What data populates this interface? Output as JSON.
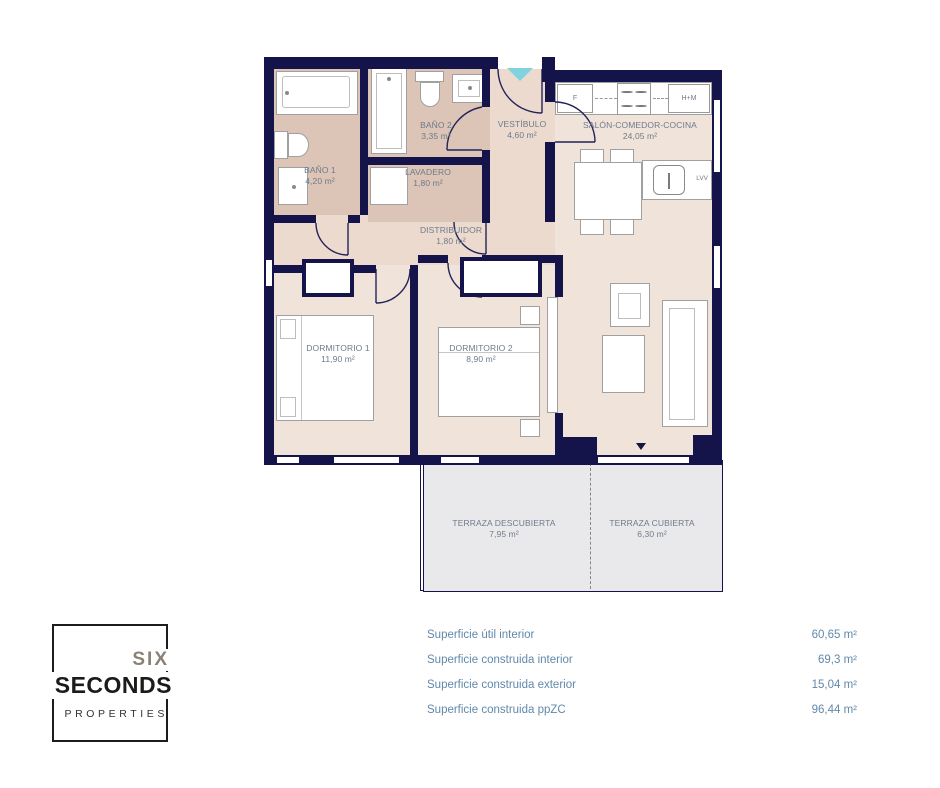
{
  "plan": {
    "rooms": {
      "bano1": {
        "name": "BAÑO 1",
        "area": "4,20 m²"
      },
      "bano2": {
        "name": "BAÑO 2",
        "area": "3,35 m²"
      },
      "lavadero": {
        "name": "LAVADERO",
        "area": "1,80 m²"
      },
      "vestibulo": {
        "name": "VESTÍBULO",
        "area": "4,60 m²"
      },
      "distribuidor": {
        "name": "DISTRIBUIDOR",
        "area": "1,80 m²"
      },
      "salon": {
        "name": "SALÓN-COMEDOR-COCINA",
        "area": "24,05 m²"
      },
      "dorm1": {
        "name": "DORMITORIO 1",
        "area": "11,90 m²"
      },
      "dorm2": {
        "name": "DORMITORIO 2",
        "area": "8,90 m²"
      },
      "terraza_descubierta": {
        "name": "TERRAZA DESCUBIERTA",
        "area": "7,95 m²"
      },
      "terraza_cubierta": {
        "name": "TERRAZA CUBIERTA",
        "area": "6,30 m²"
      }
    },
    "appliances": {
      "fridge": "F",
      "oven_micro": "H+M",
      "dishwasher": "LVV"
    },
    "colors": {
      "wall": "#14144a",
      "floor_main": "#f0e3d9",
      "floor_bath": "#dcc4b6",
      "floor_hall": "#ecdacf",
      "floor_terrace": "#e9e9ec",
      "entry_accent": "#7fd2de",
      "label_text": "#6e7b8a",
      "summary_text": "#6189aa"
    }
  },
  "logo": {
    "line1": "SIX",
    "line2": "SECONDS",
    "line3": "PROPERTIES"
  },
  "summary": {
    "rows": [
      {
        "label": "Superficie útil interior",
        "value": "60,65 m²"
      },
      {
        "label": "Superficie construida interior",
        "value": "69,3 m²"
      },
      {
        "label": "Superficie construida exterior",
        "value": "15,04 m²"
      },
      {
        "label": "Superficie construida ppZC",
        "value": "96,44 m²"
      }
    ]
  }
}
